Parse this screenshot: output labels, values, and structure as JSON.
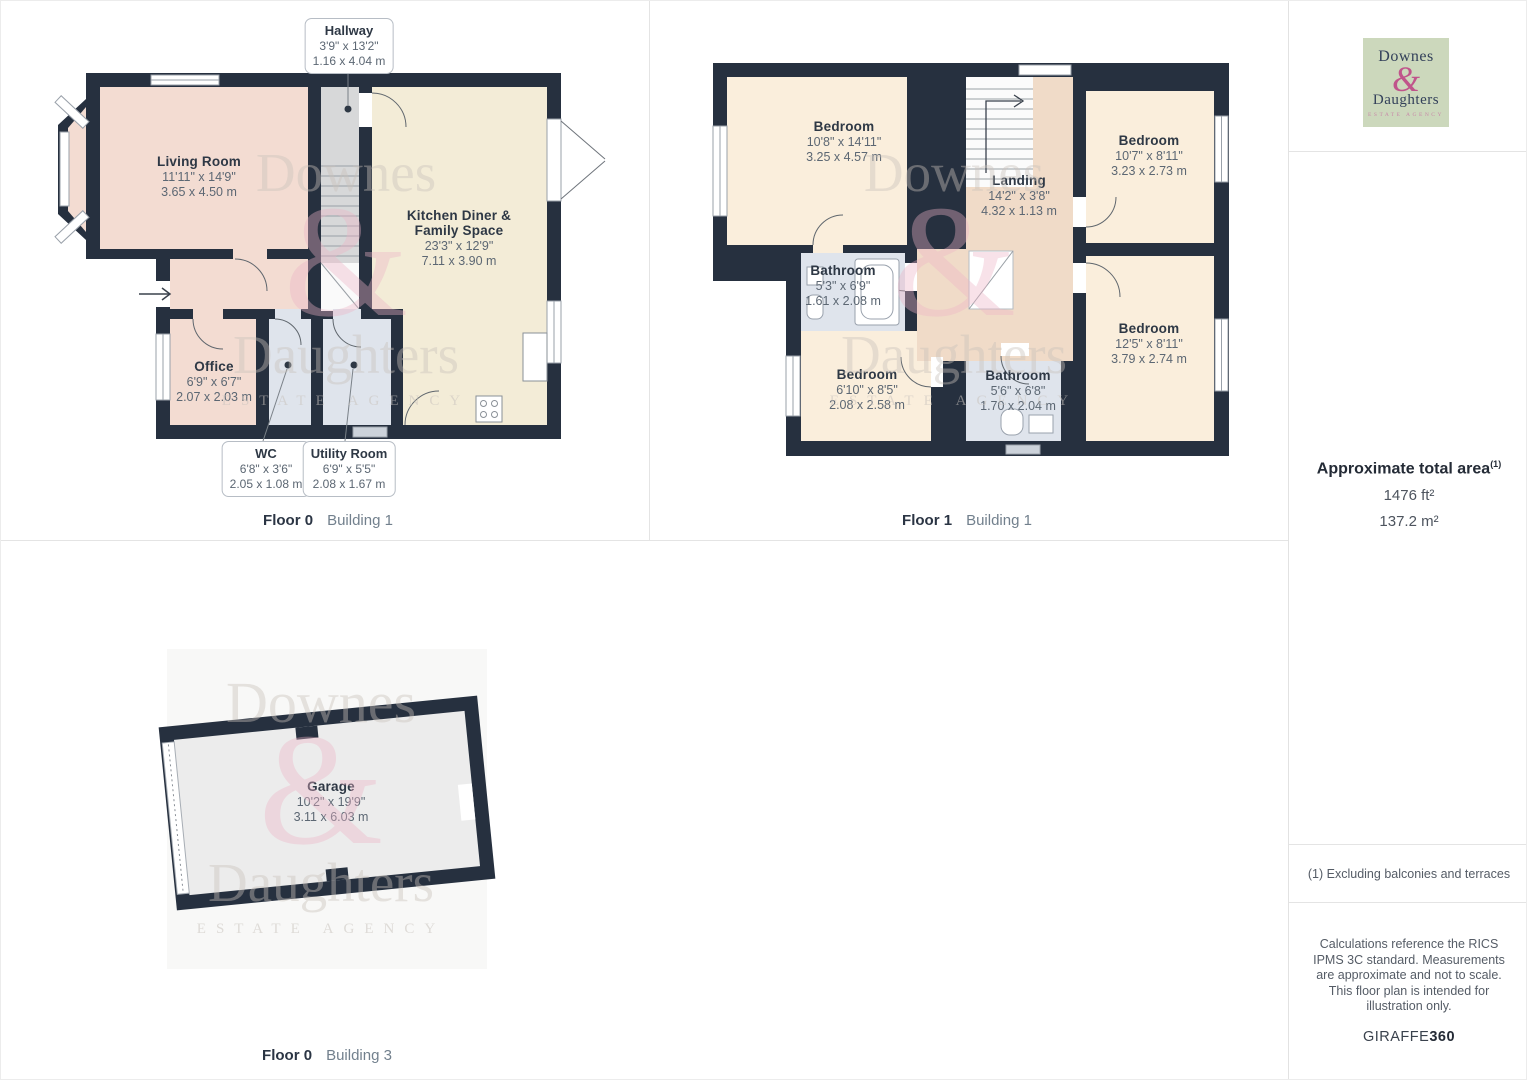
{
  "plans": {
    "plan1": {
      "caption_floor": "Floor 0",
      "caption_building": "Building 1",
      "rooms": {
        "living": {
          "name": "Living Room",
          "imperial": "11'11\" x 14'9\"",
          "metric": "3.65 x 4.50 m"
        },
        "kitchen": {
          "name": "Kitchen Diner & Family Space",
          "imperial": "23'3\" x 12'9\"",
          "metric": "7.11 x 3.90 m"
        },
        "office": {
          "name": "Office",
          "imperial": "6'9\" x 6'7\"",
          "metric": "2.07 x 2.03 m"
        }
      },
      "callouts": {
        "hallway": {
          "name": "Hallway",
          "imperial": "3'9\" x 13'2\"",
          "metric": "1.16 x 4.04 m"
        },
        "wc": {
          "name": "WC",
          "imperial": "6'8\" x 3'6\"",
          "metric": "2.05 x 1.08 m"
        },
        "utility": {
          "name": "Utility Room",
          "imperial": "6'9\" x 5'5\"",
          "metric": "2.08 x 1.67 m"
        }
      }
    },
    "plan2": {
      "caption_floor": "Floor 1",
      "caption_building": "Building 1",
      "rooms": {
        "bedroom_tl": {
          "name": "Bedroom",
          "imperial": "10'8\" x 14'11\"",
          "metric": "3.25 x 4.57 m"
        },
        "bedroom_tr": {
          "name": "Bedroom",
          "imperial": "10'7\" x 8'11\"",
          "metric": "3.23 x 2.73 m"
        },
        "landing": {
          "name": "Landing",
          "imperial": "14'2\" x 3'8\"",
          "metric": "4.32 x 1.13 m"
        },
        "bathroom_left": {
          "name": "Bathroom",
          "imperial": "5'3\" x 6'9\"",
          "metric": "1.61 x 2.08 m"
        },
        "bedroom_bl": {
          "name": "Bedroom",
          "imperial": "6'10\" x 8'5\"",
          "metric": "2.08 x 2.58 m"
        },
        "bathroom_center": {
          "name": "Bathroom",
          "imperial": "5'6\" x 6'8\"",
          "metric": "1.70 x 2.04 m"
        },
        "bedroom_right": {
          "name": "Bedroom",
          "imperial": "12'5\" x 8'11\"",
          "metric": "3.79 x 2.74 m"
        }
      }
    },
    "plan3": {
      "caption_floor": "Floor 0",
      "caption_building": "Building 3",
      "rooms": {
        "garage": {
          "name": "Garage",
          "imperial": "10'2\" x 19'9\"",
          "metric": "3.11 x 6.03 m"
        }
      }
    }
  },
  "watermark": {
    "word1": "Downes",
    "amp": "&",
    "word2": "Daughters",
    "word3": "ESTATE AGENCY"
  },
  "logo": {
    "word1": "Downes",
    "amp": "&",
    "word2": "Daughters",
    "tagline": "ESTATE AGENCY"
  },
  "sidebar": {
    "area_title": "Approximate total area",
    "area_footnote_marker": "(1)",
    "area_imperial": "1476 ft²",
    "area_metric": "137.2 m²",
    "footnote": "(1) Excluding balconies and terraces",
    "disclaimer": "Calculations reference the RICS IPMS 3C standard. Measurements are approximate and not to scale. This floor plan is intended for illustration only.",
    "brand_name": "GIRAFFE",
    "brand_suffix": "360"
  },
  "colors": {
    "wall": "#26303f",
    "room_pink": "#f3dcd2",
    "room_cream": "#f3ecd7",
    "room_peach": "#faeedc",
    "landing_peach": "#f0dbc8",
    "hall_gray": "#d7d8d9",
    "bath_blue": "#dfe4ec",
    "garage_gray": "#ececec",
    "logo_green": "#ccd8bc",
    "logo_pink": "#c0548b"
  }
}
